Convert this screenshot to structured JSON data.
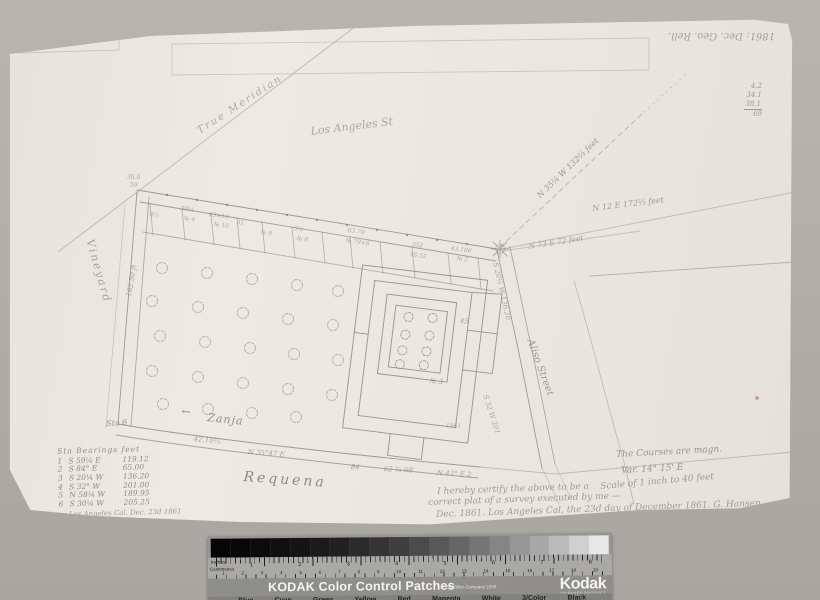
{
  "palette": {
    "photo_background": "#b2afaa",
    "paper": "#eae7e1",
    "pencil": "#6f6a5f",
    "red_speck": "#b3572f",
    "kodak_gray": "#969591"
  },
  "map": {
    "notes": {
      "date_top_left": "1861: Dec.",
      "date_top_right_inverted": "1861: Dec.  Geo. Rell.",
      "sum_column": [
        "4.2",
        "34.1",
        "38.1",
        "69"
      ],
      "corner_note_1": "36.6",
      "corner_note_2": "59",
      "true_meridian": "True Meridian",
      "street_top": "Los Angeles St",
      "tie_dashed": "N 35¼ W 132⅔ feet",
      "tie_upper": "N 12 E 172⅔ feet",
      "tie_lower": "N 73 E 72 feet",
      "street_left": "Vineyard",
      "left_measure": "182.50 ft",
      "zanja_arrow": "←",
      "zanja": "Zanja",
      "station_6": "Sta 6",
      "bottom_measure_1": "42.10⅔",
      "bottom_measure_2": "N 35°47 E",
      "bottom_measure_3": "84",
      "bottom_measure_4": "62 ¾ 68'",
      "bottom_measure_5": "N 43° E 2",
      "street_bottom": "Requena",
      "right_bearing_1": "S 20¼ W 136.20",
      "right_bearing_2": "S 32 W 201",
      "street_right": "Aliso Street",
      "lot_labels": [
        "8½",
        "50¼",
        "№ 4",
        "43×10",
        "№ 10",
        "31",
        "№ 9",
        "5¼",
        "№ 8",
        "63.70",
        "№ 79×6",
        "352",
        "18.52",
        "43.106",
        "№ 2"
      ],
      "building_labels": [
        "45",
        "№ 3",
        "1861"
      ],
      "courses_note_1": "The Courses are magn.",
      "courses_note_2": "Var. 14° 15' E",
      "scale_note": "Scale of 1 inch to 40 feet",
      "cert_line_1": "I hereby certify the above to be a",
      "cert_line_2": "correct plat of a survey executed by me —",
      "cert_line_3": "Dec. 1861. Los Angeles Cal, the 23d day of December 1861. G. Hansen"
    },
    "bearing_table": {
      "header": "Sta Bearings feet",
      "rows": [
        {
          "no": "1",
          "bearing": "S 59¼ E",
          "feet": "119.12"
        },
        {
          "no": "2",
          "bearing": "S 84° E",
          "feet": "65.00"
        },
        {
          "no": "3",
          "bearing": "S 20¼ W",
          "feet": "136.20"
        },
        {
          "no": "4",
          "bearing": "S 32° W",
          "feet": "201.00"
        },
        {
          "no": "5",
          "bearing": "N 58¼ W",
          "feet": "189.95"
        },
        {
          "no": "6",
          "bearing": "S 30¼ W",
          "feet": "205.25"
        }
      ],
      "footer": "Los Angeles Cal. Dec. 23d 1861"
    }
  },
  "kodak": {
    "title": "KODAK Color Control Patches",
    "copyright": "© The Tiffen Company 2000",
    "brand": "Kodak",
    "licensed": "LICENSED PRODUCT",
    "ruler_top_label": "Inches",
    "ruler_bottom_label": "Centimetres",
    "inch_numbers": [
      "1",
      "2",
      "3",
      "4",
      "5",
      "6",
      "7",
      "8"
    ],
    "cm_numbers": [
      "1",
      "2",
      "3",
      "4",
      "5",
      "6",
      "7",
      "8",
      "9",
      "10",
      "11",
      "12",
      "13",
      "14",
      "15",
      "16",
      "17",
      "18",
      "19"
    ],
    "color_labels": [
      "Blue",
      "Cyan",
      "Green",
      "Yellow",
      "Red",
      "Magenta",
      "White",
      "3/Color",
      "Black"
    ],
    "grayscale_patches": [
      "#060606",
      "#080808",
      "#0b0b0b",
      "#0f0f0f",
      "#141414",
      "#1a1a1a",
      "#212121",
      "#2a2a2a",
      "#343434",
      "#3f3f3f",
      "#4b4b4b",
      "#585858",
      "#666666",
      "#757575",
      "#858585",
      "#969696",
      "#a8a8a8",
      "#bbbbbb",
      "#d0d0d0",
      "#e8e8e8"
    ]
  }
}
